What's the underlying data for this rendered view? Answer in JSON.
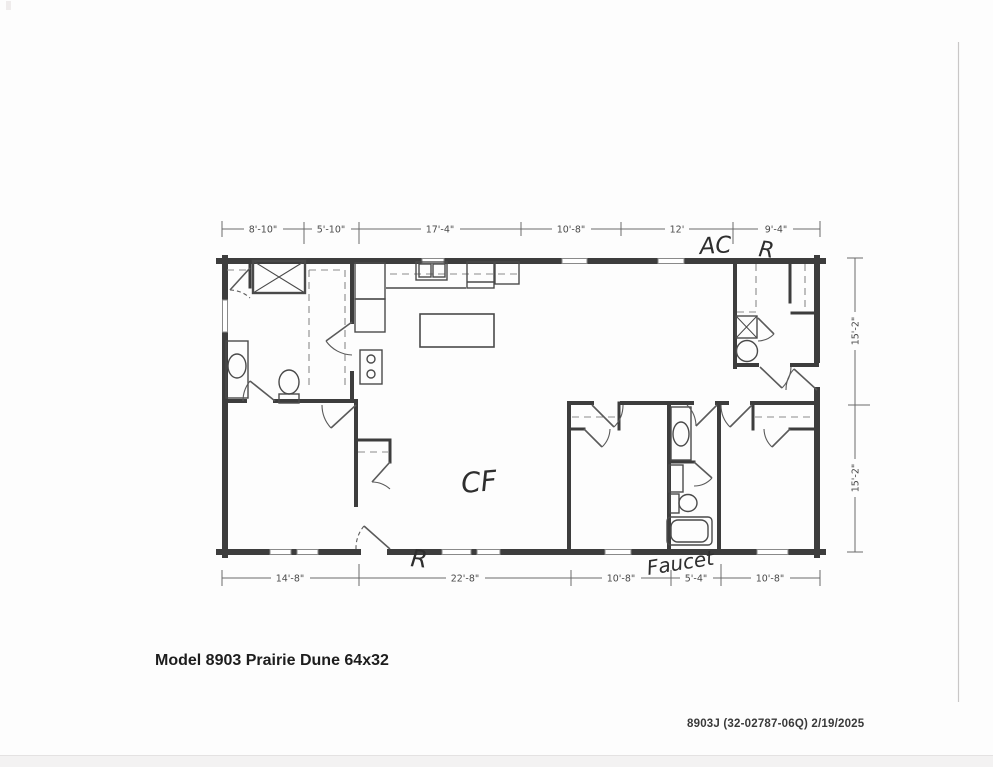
{
  "document": {
    "title": "Model 8903 Prairie Dune 64x32",
    "plan_code": "8903J  (32-02787-06Q)  2/19/2025"
  },
  "dimensions": {
    "top": [
      "8'-10\"",
      "5'-10\"",
      "17'-4\"",
      "10'-8\"",
      "12'",
      "9'-4\""
    ],
    "bottom": [
      "14'-8\"",
      "22'-8\"",
      "10'-8\"",
      "5'-4\"",
      "10'-8\""
    ],
    "right": [
      "15'-2\"",
      "15'-2\""
    ]
  },
  "handwritten": {
    "ac": "AC",
    "r_top": "R",
    "cf": "CF",
    "r_bottom": "R",
    "faucet": "Faucet"
  }
}
